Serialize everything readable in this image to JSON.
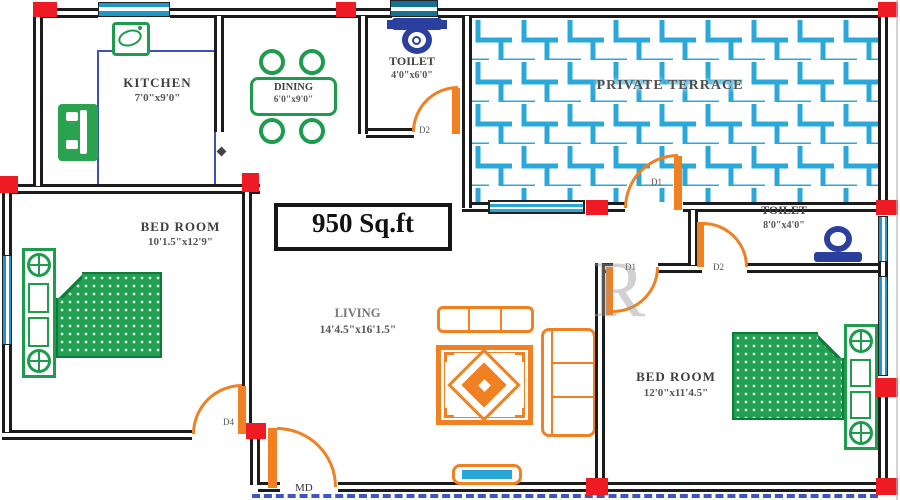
{
  "area_label": "950 Sq.ft",
  "watermark": "R",
  "rooms": {
    "kitchen": {
      "name": "KITCHEN",
      "dims": "7'0\"x9'0\""
    },
    "dining": {
      "name": "DINING",
      "dims": "6'0\"x9'0\""
    },
    "toilet_top": {
      "name": "TOILET",
      "dims": "4'0\"x6'0\""
    },
    "terrace": {
      "name": "PRIVATE TERRACE"
    },
    "toilet_right": {
      "name": "TOILET",
      "dims": "8'0\"x4'0\""
    },
    "bedroom_left": {
      "name": "BED ROOM",
      "dims": "10'1.5\"x12'9\""
    },
    "living": {
      "name": "LIVING",
      "dims": "14'4.5\"x16'1.5\""
    },
    "bedroom_right": {
      "name": "BED ROOM",
      "dims": "12'0\"x11'4.5\""
    }
  },
  "doors": {
    "toilet_top": "D2",
    "terrace": "D1",
    "bedroom_right": "D1",
    "toilet_right": "D2",
    "bedroom_left": "D4",
    "main": "MD"
  },
  "colors": {
    "wall": "#1c1c1c",
    "door_orange": "#f08021",
    "furniture_green": "#1e9b4d",
    "window_blue": "#2aa5d8",
    "corner_red": "#ee1b24",
    "wc_blue": "#2b3f9e"
  }
}
